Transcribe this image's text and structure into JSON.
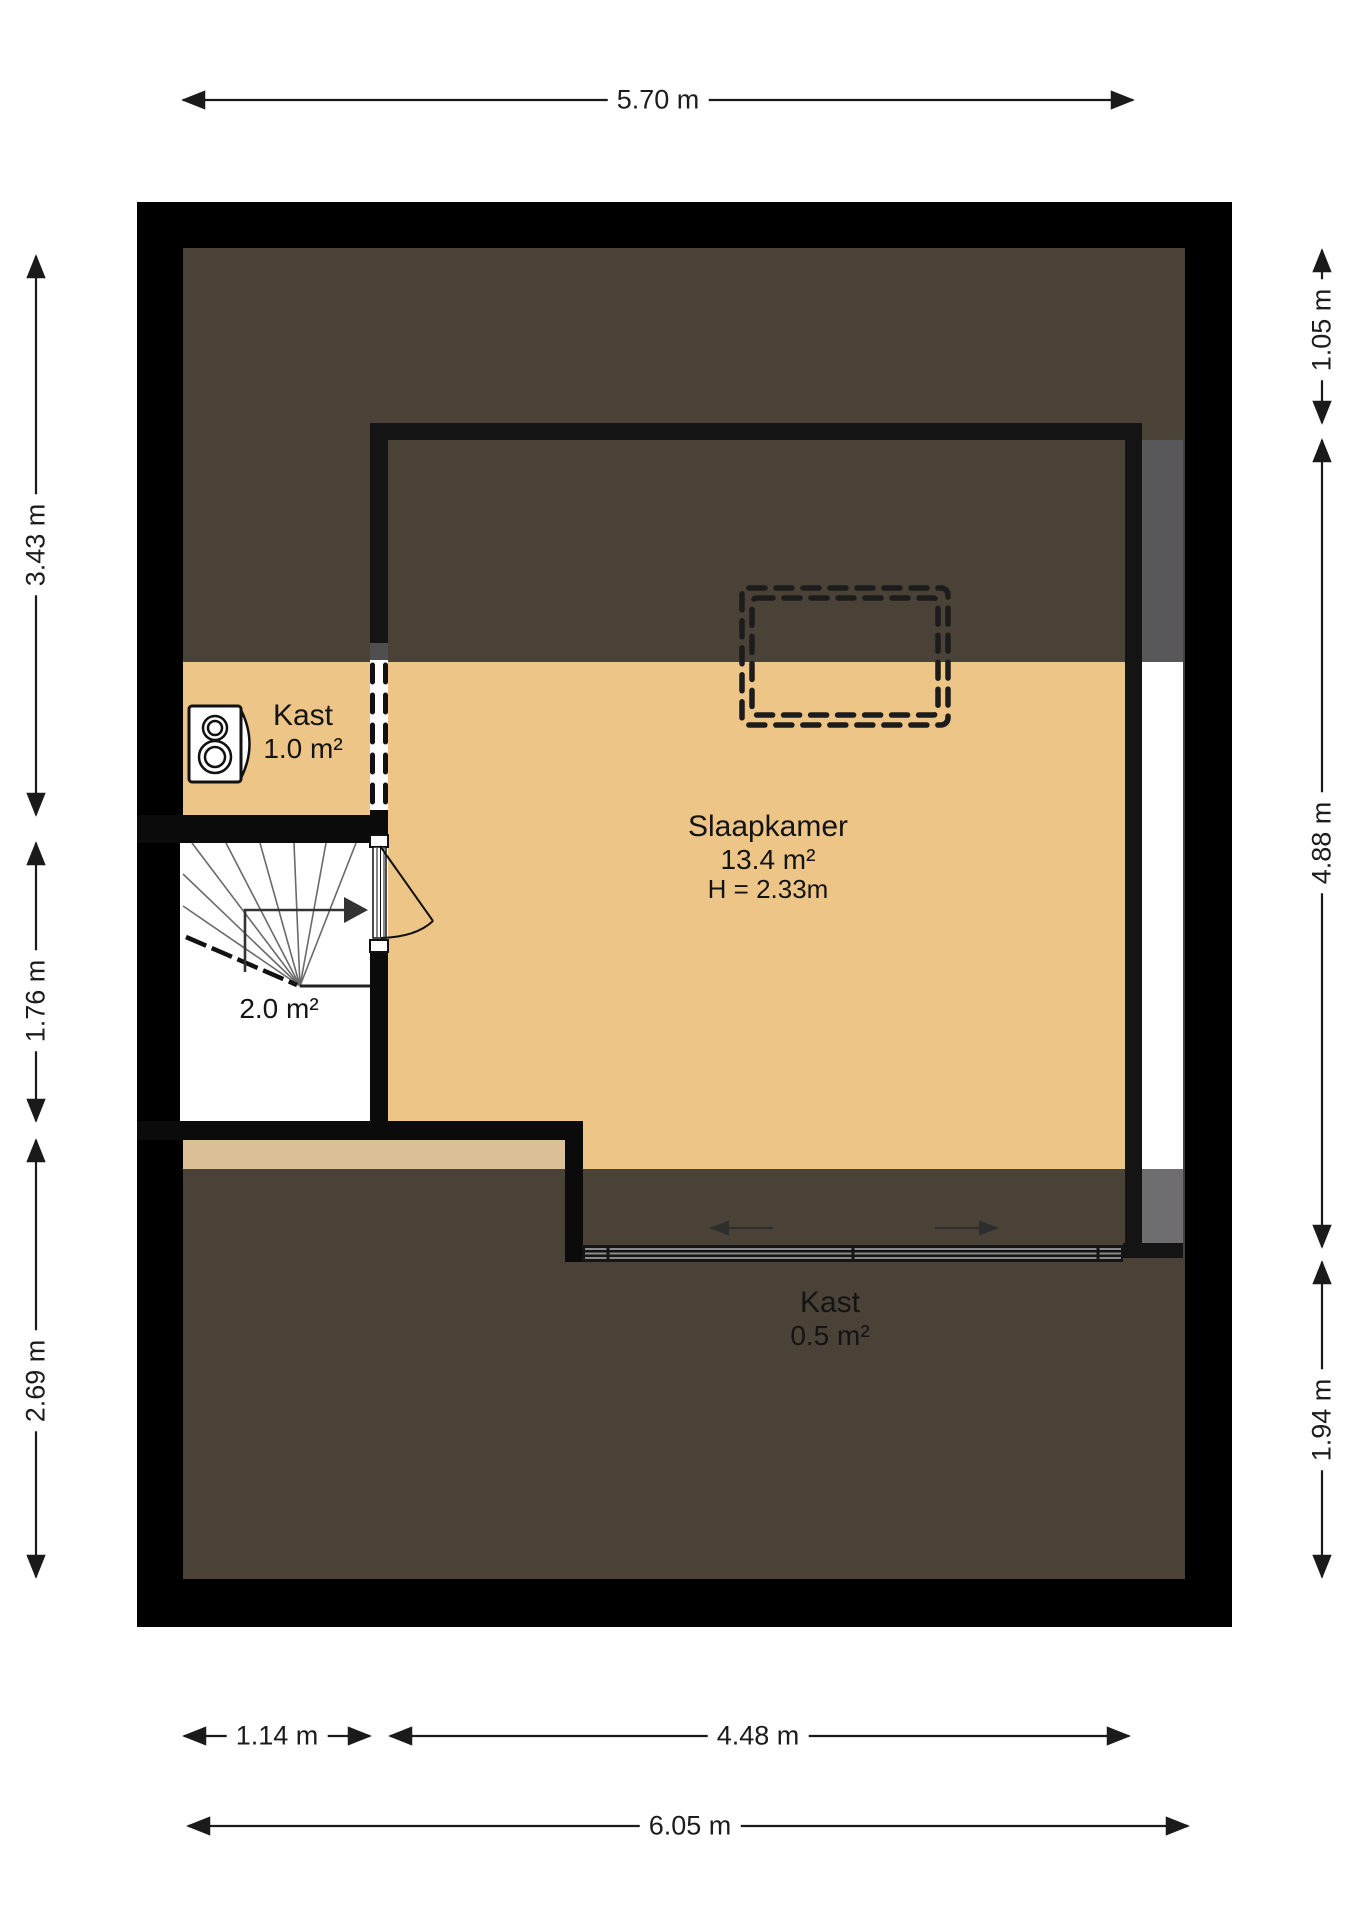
{
  "plan": {
    "type_label": "floor-plan",
    "rooms": {
      "closet_top": {
        "name": "Kast",
        "area": "1.0 m²"
      },
      "bedroom": {
        "name": "Slaapkamer",
        "area": "13.4 m²",
        "ceiling_height": "H = 2.33m"
      },
      "stairwell": {
        "area": "2.0 m²"
      },
      "closet_bottom": {
        "name": "Kast",
        "area": "0.5 m²"
      }
    },
    "dimensions": {
      "top_width": "5.70 m",
      "bottom_left_width": "1.14 m",
      "bottom_right_width": "4.48 m",
      "bottom_total_width": "6.05 m",
      "left_top_height": "3.43 m",
      "left_middle_height": "1.76 m",
      "left_bottom_height": "2.69 m",
      "right_top_height": "1.05 m",
      "right_middle_height": "4.88 m",
      "right_bottom_height": "1.94 m"
    },
    "colors": {
      "outer_wall": "#000000",
      "inner_wall": "#141414",
      "low_ceiling_floor": "#4a4236",
      "room_floor_tan": "#ecc587",
      "landing_floor_tan": "#dcc098",
      "stairs_floor": "#ffffff",
      "window_shade_dark": "#58585a",
      "window_shade_light": "#6e6e70",
      "dimension_text": "#1c1c1c"
    },
    "icons": {
      "boiler": "boiler-icon",
      "stairs": "stairs-icon",
      "door": "door-swing-icon",
      "dormer": "dormer-dashed-outline",
      "sliding_door": "sliding-door-track"
    }
  }
}
